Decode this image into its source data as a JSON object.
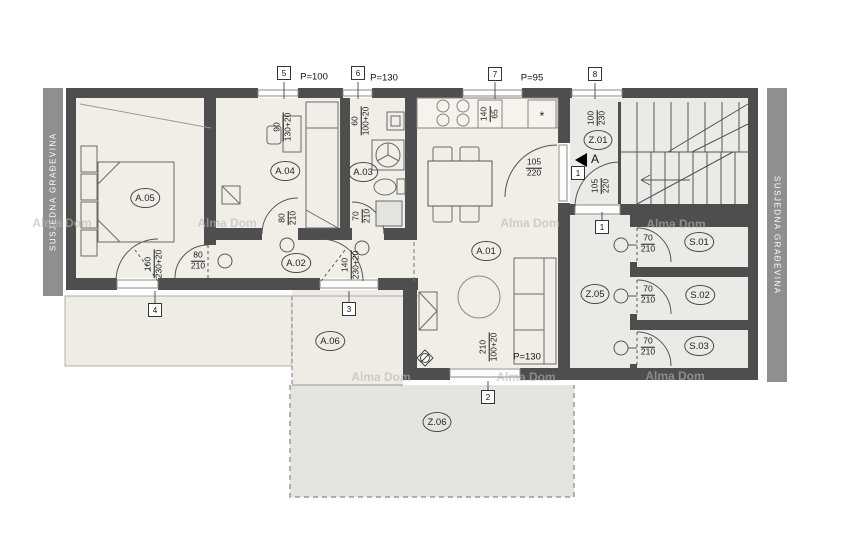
{
  "colors": {
    "wall": "#4e4e4e",
    "floor": "#f1eee7",
    "common": "#eaeae6",
    "terrace": "#efece5",
    "terrace2": "#e4e4e1",
    "bar": "#8f8f8f",
    "line": "#555555",
    "wm": "#b8b6ae"
  },
  "labels": {
    "side": "SUSJEDNA GRAĐEVINA",
    "watermark": "Alma Dom",
    "section": "A",
    "rooms": {
      "a01": "A.01",
      "a02": "A.02",
      "a03": "A.03",
      "a04": "A.04",
      "a05": "A.05",
      "a06": "A.06",
      "z01": "Z.01",
      "z05": "Z.05",
      "z06": "Z.06",
      "s01": "S.01",
      "s02": "S.02",
      "s03": "S.03"
    },
    "markers": {
      "m5": "5",
      "m6": "6",
      "m7": "7",
      "m8": "8",
      "m4": "4",
      "m3": "3",
      "m2": "2",
      "m1a": "1",
      "m1b": "1"
    },
    "parapets": {
      "p5": "P=100",
      "p6": "P=130",
      "p7": "P=95",
      "p_bottom": "P=130"
    },
    "symbols": {
      "fridge": "*"
    },
    "dims": {
      "a04_window": {
        "a": "90",
        "b": "130+20"
      },
      "a03_window": {
        "a": "60",
        "b": "100+20"
      },
      "kitchen_unit": {
        "a": "140",
        "b": "65"
      },
      "z01_window": {
        "a": "100",
        "b": "230"
      },
      "z01_door": {
        "a": "105",
        "b": "220"
      },
      "entry_door": {
        "a": "105",
        "b": "220"
      },
      "a05_balcony": {
        "a": "160",
        "b": "230+20"
      },
      "a02_balcony": {
        "a": "140",
        "b": "230+20"
      },
      "a01_window": {
        "a": "210",
        "b": "100+20"
      },
      "a05_door": {
        "a": "80",
        "b": "210"
      },
      "a04_door": {
        "a": "80",
        "b": "210"
      },
      "a03_door": {
        "a": "70",
        "b": "210"
      },
      "s01_door": {
        "a": "70",
        "b": "210"
      },
      "s02_door": {
        "a": "70",
        "b": "210"
      },
      "s03_door": {
        "a": "70",
        "b": "210"
      }
    }
  }
}
